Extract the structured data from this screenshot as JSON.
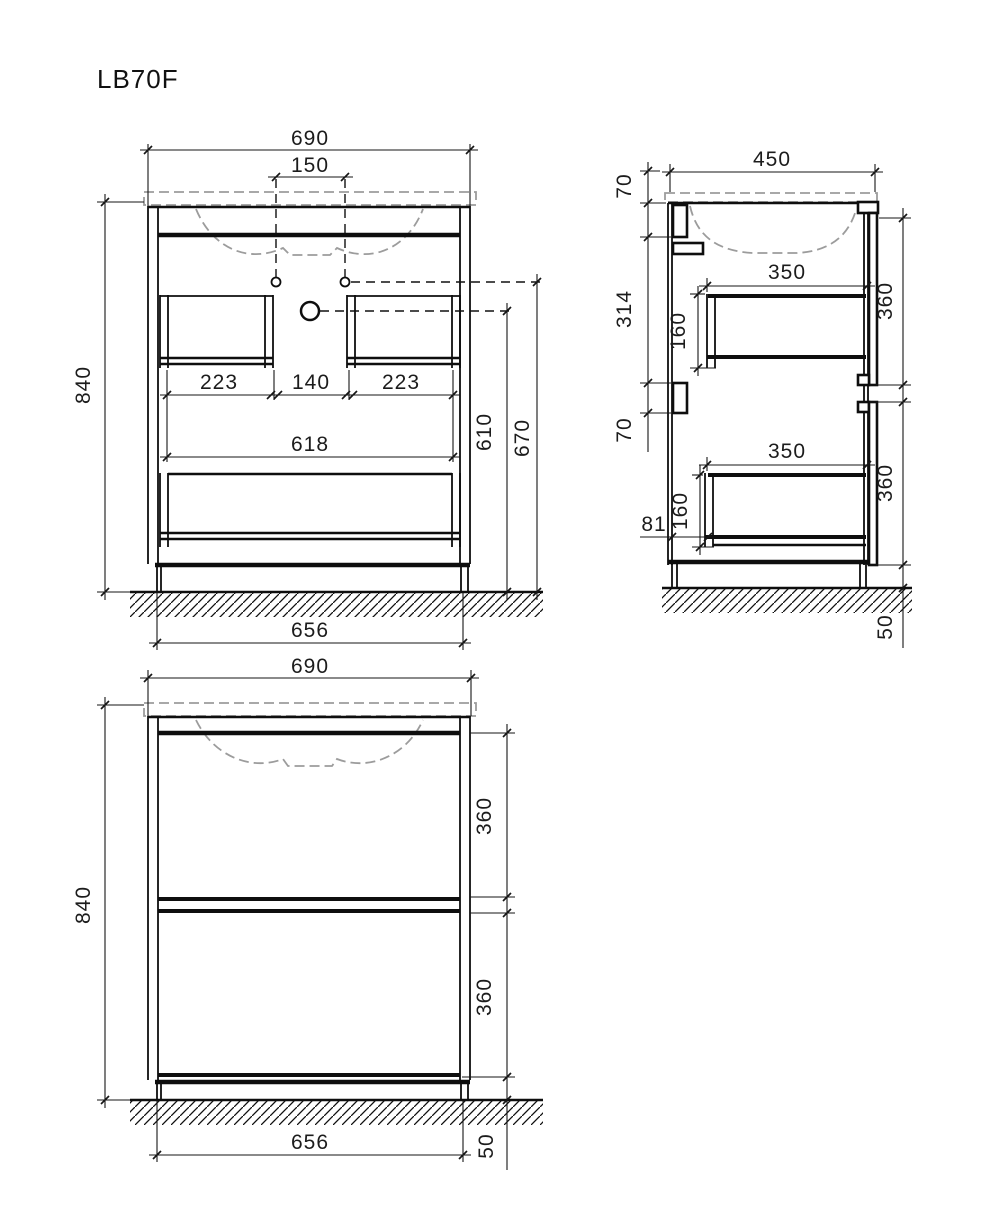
{
  "title": "LB70F",
  "front_view": {
    "overall_width": "690",
    "faucet_spacing": "150",
    "overall_height": "840",
    "left_drawer_width": "223",
    "center_gap": "140",
    "right_drawer_width": "223",
    "interior_width": "618",
    "drain_height": "610",
    "faucet_height": "670",
    "base_width": "656"
  },
  "side_view": {
    "depth": "450",
    "top_rail_offset": "70",
    "back_rail_spacing": "314",
    "lower_rail_height": "70",
    "upper_drawer_depth": "350",
    "upper_drawer_side_height": "160",
    "upper_front_height": "360",
    "back_offset": "81",
    "lower_drawer_depth": "350",
    "lower_drawer_side_height": "160",
    "lower_front_height": "360",
    "plinth_height": "50"
  },
  "bottom_view": {
    "overall_width": "690",
    "overall_height": "840",
    "upper_front_height": "360",
    "lower_front_height": "360",
    "base_width": "656",
    "plinth_height": "50"
  }
}
